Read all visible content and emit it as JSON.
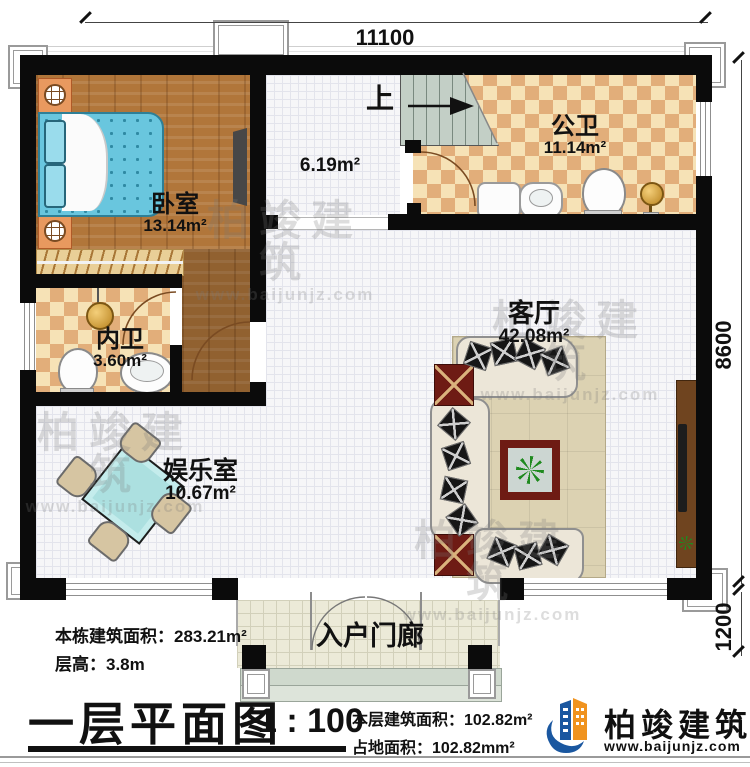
{
  "plan": {
    "dims": {
      "top": "11100",
      "right": "8600",
      "porch": "1200"
    },
    "stairs": {
      "up_label": "上"
    },
    "rooms": {
      "bedroom": {
        "name": "卧室",
        "area": "13.14m²"
      },
      "hall": {
        "area": "6.19m²"
      },
      "public_bath": {
        "name": "公卫",
        "area": "11.14m²"
      },
      "inner_bath": {
        "name": "内卫",
        "area": "3.60m²"
      },
      "living": {
        "name": "客厅",
        "area": "42.08m²"
      },
      "entertainment": {
        "name": "娱乐室",
        "area": "10.67m²"
      },
      "porch": {
        "name": "入户门廊"
      }
    }
  },
  "info": {
    "building_area": "本栋建筑面积：283.21m²",
    "floor_height": "层高：3.8m"
  },
  "title_block": {
    "title": "一层平面图",
    "scale": "1 : 100",
    "floor_area": "本层建筑面积：102.82m²",
    "land_area": "占地面积：102.82mm²"
  },
  "brand": {
    "name": "柏竣建筑",
    "url": "www.baijunjz.com"
  },
  "watermark": {
    "name": "柏竣建筑",
    "url": "www.baijunjz.com"
  },
  "colors": {
    "wall": "#0b0b0b",
    "wood_floor": "#b1763a",
    "checker_light": "#f6e2b6",
    "checker_dark": "#e2ae7a",
    "stairs": "#c3cfc6",
    "bed": "#69c6de",
    "mahjong_table": "#ace0e0",
    "rug": "#dcd2b2",
    "accent_red": "#6e1b14",
    "logo_blue": "#1a57a0",
    "logo_orange": "#f0931f"
  }
}
